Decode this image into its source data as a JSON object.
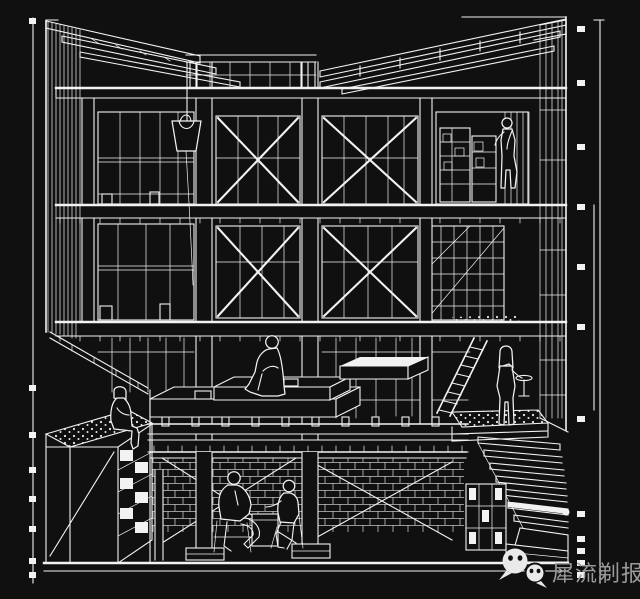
{
  "scene": {
    "type": "architectural sectional perspective line drawing",
    "style": "white line art on black background",
    "background_color": "#101010",
    "line_color": "#f2f2f2"
  },
  "watermark": {
    "icon": "wechat-logo-icon",
    "text": "犀流剃报",
    "text_color": "#9a9a9a"
  },
  "drawing": {
    "levels": [
      "butterfly roof",
      "upper floor",
      "middle floor",
      "mezzanine platforms",
      "basement"
    ],
    "elements": [
      "roof-rafters",
      "floor-slabs",
      "columns",
      "window-mullions",
      "cross-bracing",
      "hanging-bucket",
      "ladder",
      "staircase",
      "planter-box",
      "brick-walls",
      "scale-ruler-left",
      "scale-ruler-right"
    ],
    "figures": [
      "person-climbing-upper-right",
      "person-sitting-platform-center",
      "person-sitting-ledge-left",
      "person-standing-lower-right",
      "person-seated-basement-left",
      "person-seated-basement-right"
    ]
  }
}
